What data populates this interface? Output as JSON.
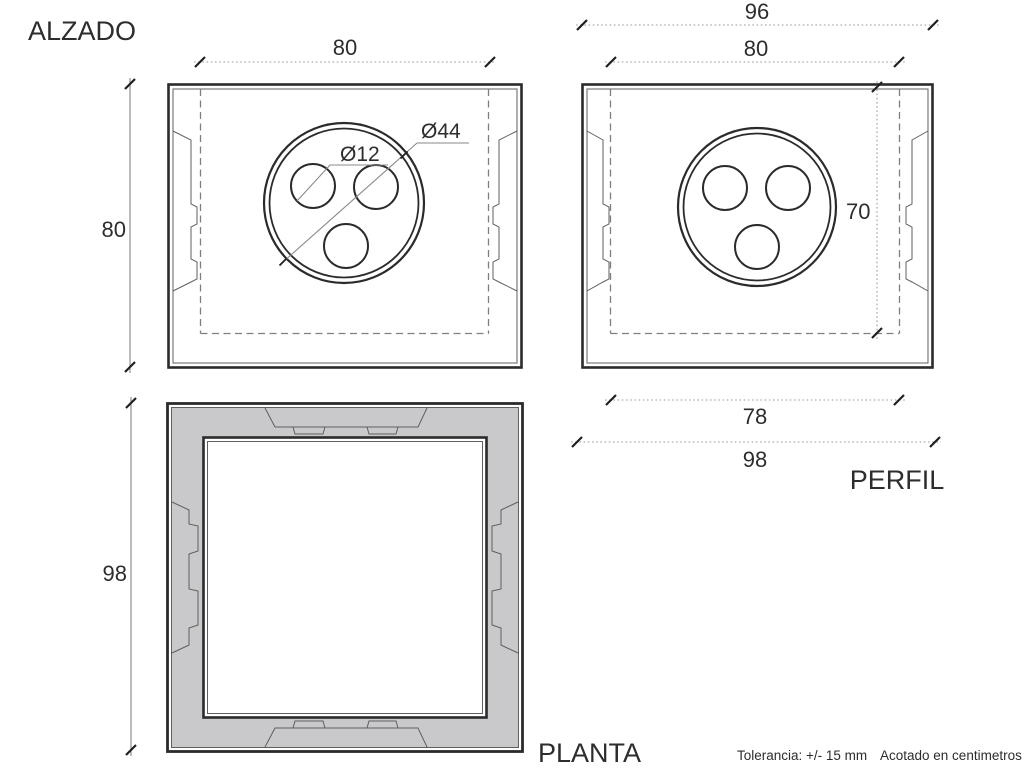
{
  "alzado": {
    "title": "ALZADO",
    "dim_top": "80",
    "dim_left": "80",
    "dia_outer": "Ø44",
    "dia_holes": "Ø12"
  },
  "perfil": {
    "title": "PERFIL",
    "dim_top_outer": "96",
    "dim_top_inner": "80",
    "dim_right": "70",
    "dim_bottom_inner": "78",
    "dim_bottom_outer": "98"
  },
  "planta": {
    "title": "PLANTA",
    "dim_left": "98"
  },
  "footer": {
    "tolerance": "Tolerancia: +/- 15 mm",
    "units": "Acotado en centimetros"
  },
  "colors": {
    "line_dark": "#2b2b2b",
    "line_thin": "#5f5f5f",
    "dim_line": "#9a9a9a",
    "frame_fill": "#c9c9cc",
    "background": "#ffffff",
    "text": "#2d2d2d"
  }
}
